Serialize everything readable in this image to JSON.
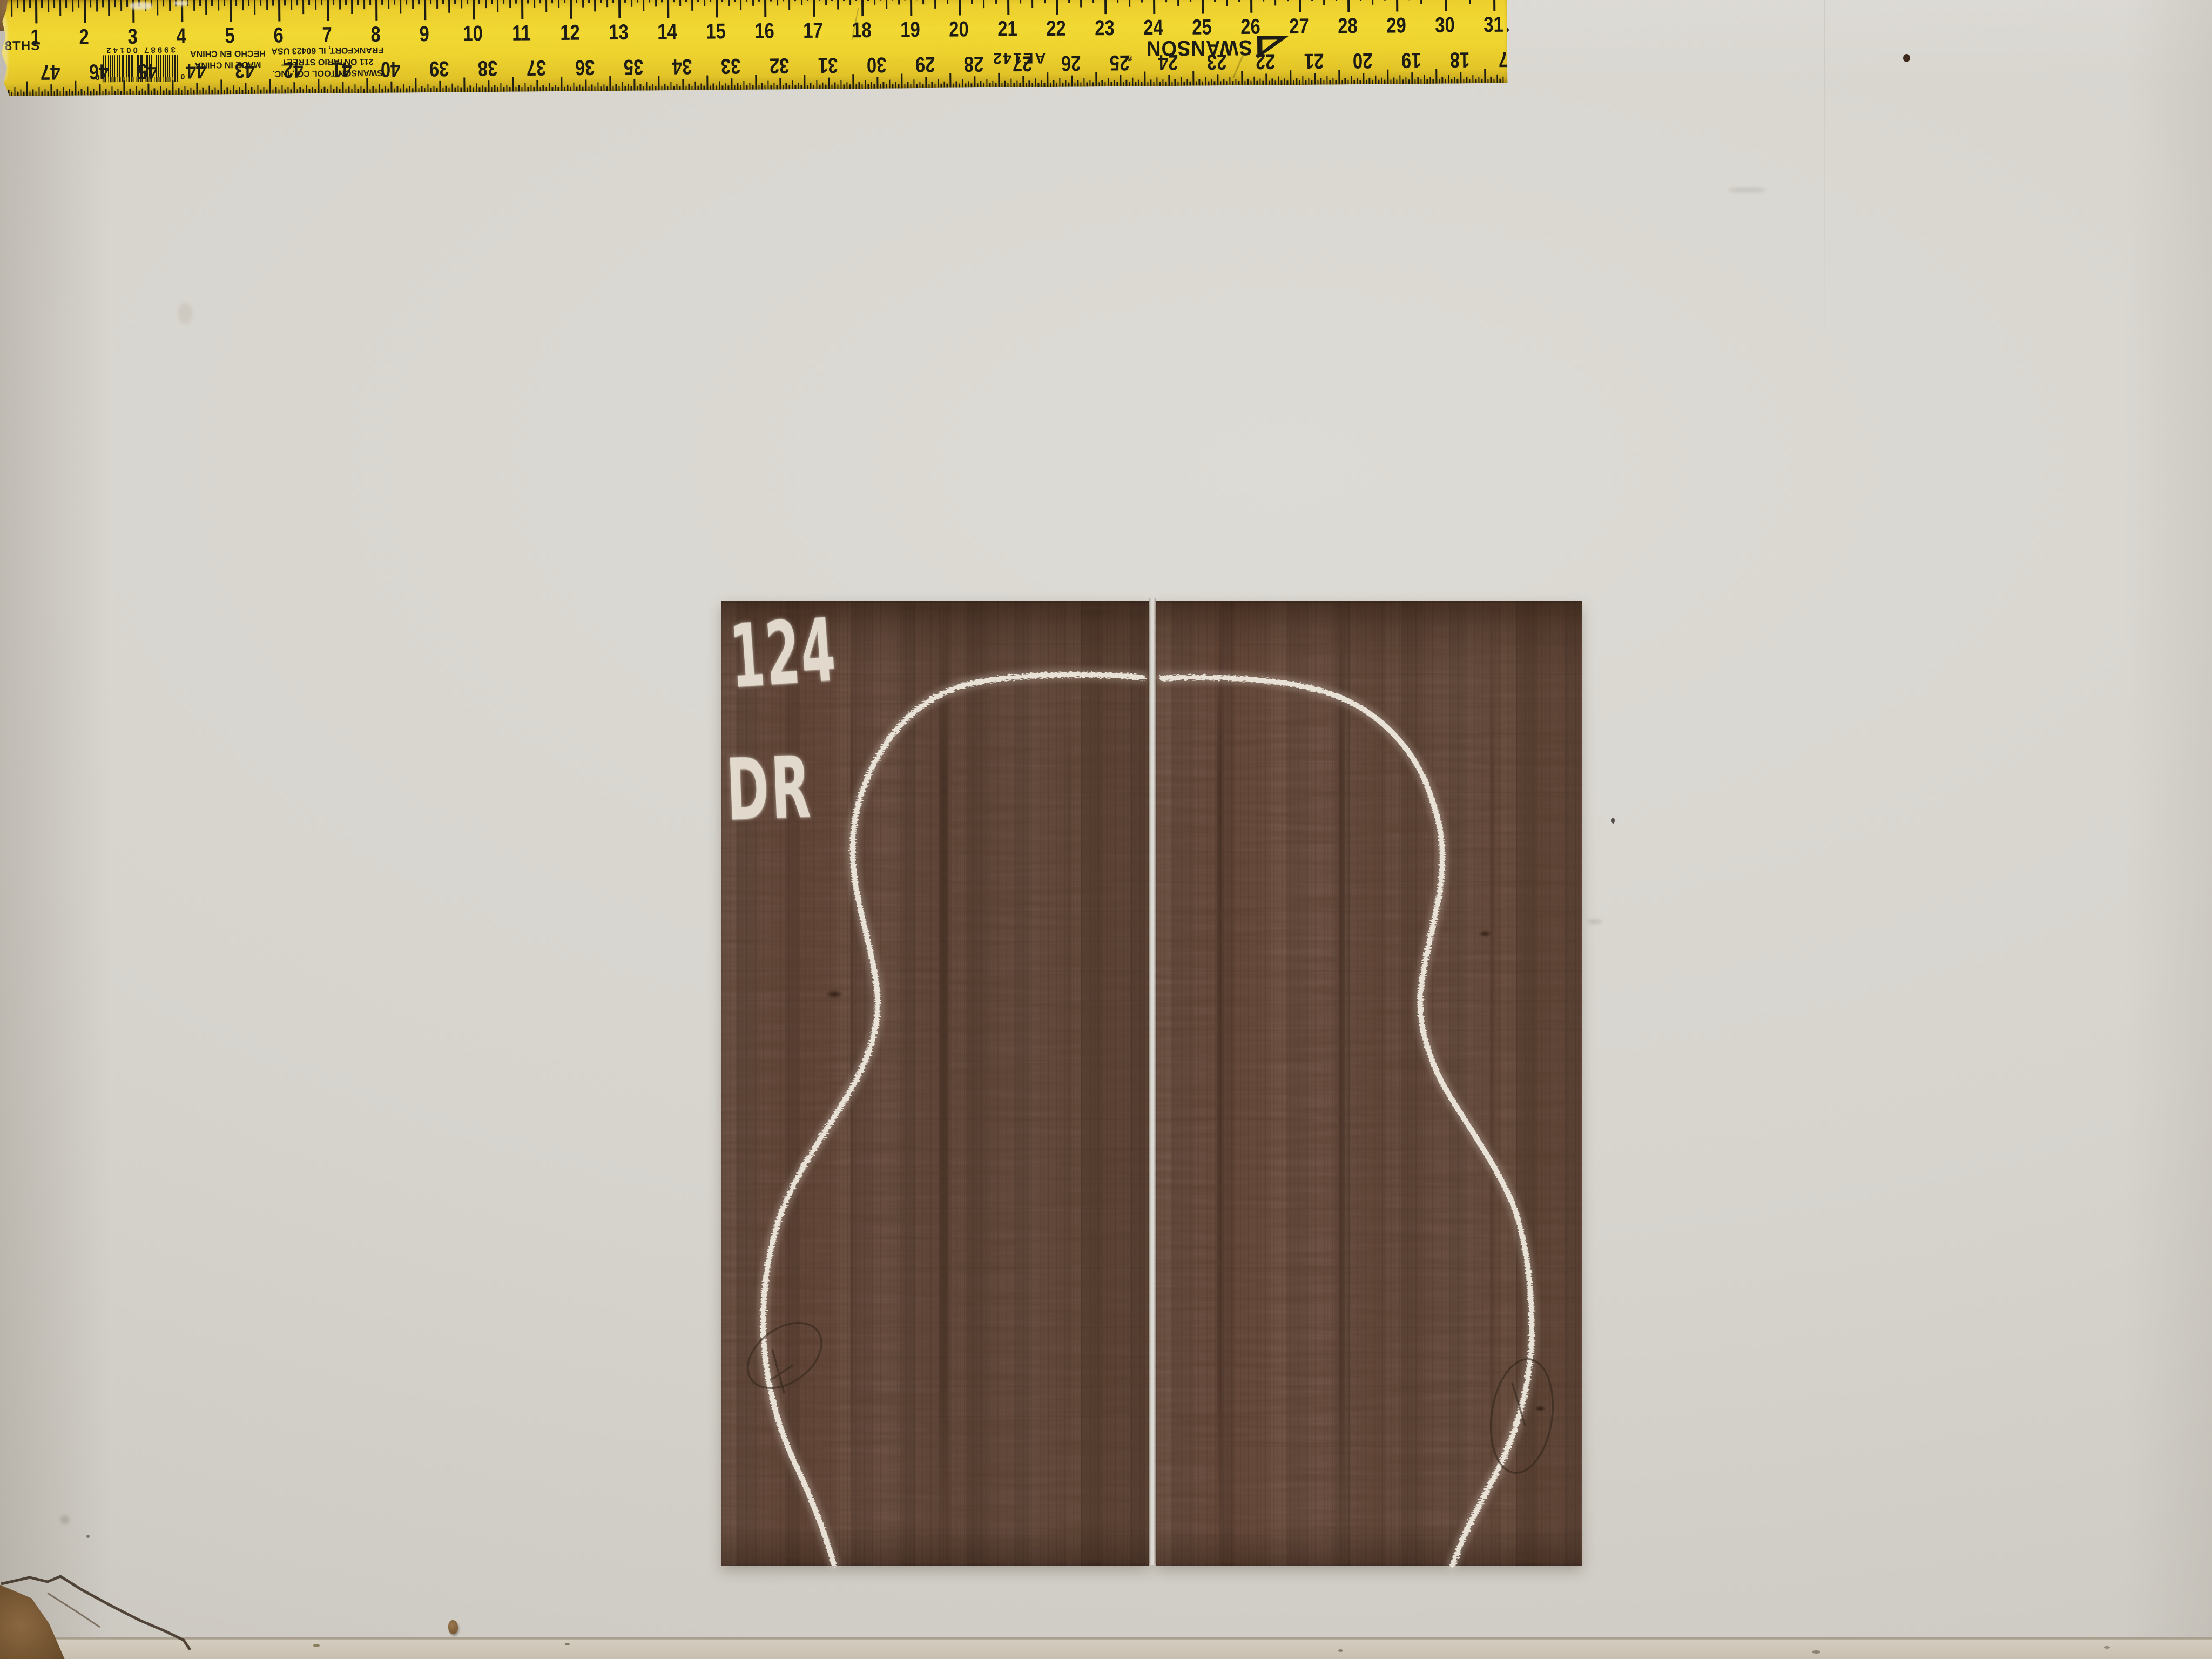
{
  "chalk": {
    "lot_number": "124",
    "model_code": "DR"
  },
  "ruler": {
    "scale_label": "8THS",
    "brand": "SWANSON",
    "registered_mark": "®",
    "model": "AE142",
    "upc": {
      "left_digit": "0",
      "digits": "39987 00142",
      "right_digit": "0"
    },
    "origin_lines": [
      "MADE IN CHINA",
      "HECHO EN CHINA"
    ],
    "address_lines": [
      "SWANSON TOOL CO., INC.",
      "211 ONTARIO STREET",
      "FRANKFORT, IL 60423 USA"
    ],
    "top_numbers": [
      1,
      2,
      3,
      4,
      5,
      6,
      7,
      8,
      9,
      10,
      11,
      12,
      13,
      14,
      15,
      16,
      17,
      18,
      19,
      20,
      21,
      22,
      23,
      24,
      25,
      26,
      27,
      28,
      29,
      30,
      31
    ],
    "bottom_numbers": [
      47,
      46,
      45,
      44,
      43,
      42,
      41,
      40,
      39,
      38,
      37,
      36,
      35,
      34,
      33,
      32,
      31,
      30,
      29,
      28,
      27,
      26,
      25,
      24,
      23,
      22,
      21,
      20,
      19,
      18,
      17
    ],
    "colors": {
      "body": "#eccf2e",
      "ink": "#1e1d15"
    }
  },
  "colors": {
    "wall": "#d7d4ce",
    "wood": "#6a5045",
    "chalk": "#f0eadf",
    "floor": "#cdc5b6"
  }
}
